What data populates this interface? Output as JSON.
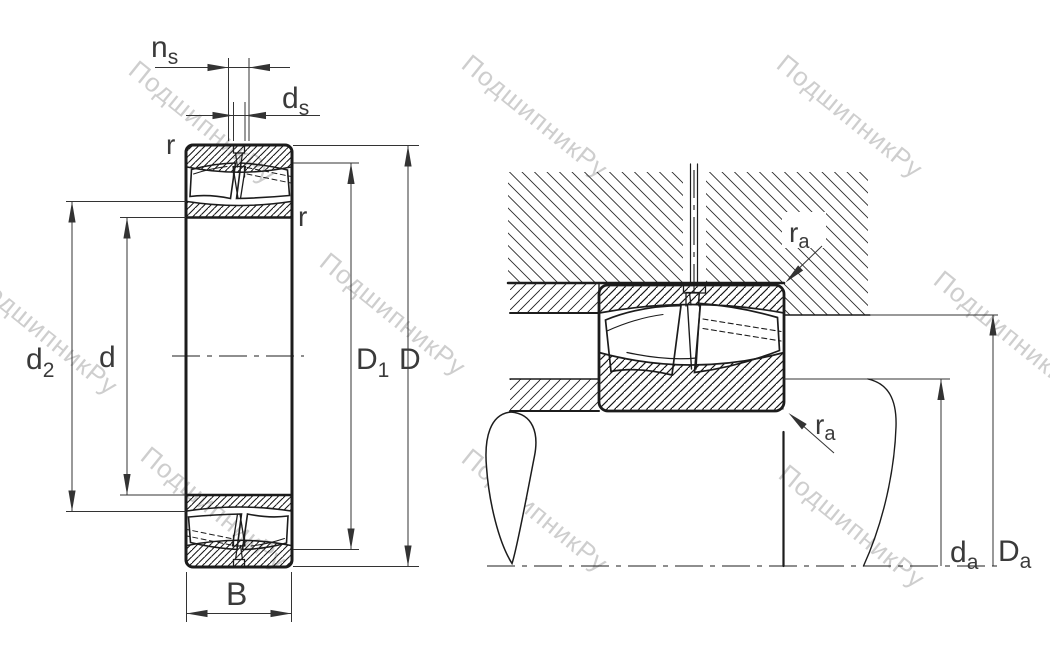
{
  "figure": {
    "type": "technical-drawing",
    "views": [
      "bearing-cross-section",
      "mounted-bearing-abutment"
    ]
  },
  "labels": {
    "ns": {
      "main": "n",
      "sub": "s"
    },
    "ds": {
      "main": "d",
      "sub": "s"
    },
    "r_outer": "r",
    "r_inner": "r",
    "d2": {
      "main": "d",
      "sub": "2"
    },
    "d": "d",
    "D1": {
      "main": "D",
      "sub": "1"
    },
    "D": "D",
    "B": "B",
    "ra_housing": {
      "main": "r",
      "sub": "a"
    },
    "ra_shaft": {
      "main": "r",
      "sub": "a"
    },
    "da": {
      "main": "d",
      "sub": "a"
    },
    "Da": {
      "main": "D",
      "sub": "a"
    }
  },
  "watermark": {
    "text": "ПодшипникРу",
    "color": "#c9c9c9",
    "angle_deg": 39
  },
  "colors": {
    "background": "#ffffff",
    "line": "#1c1c1c",
    "dimension": "#333333",
    "label": "#3a3a3a"
  }
}
